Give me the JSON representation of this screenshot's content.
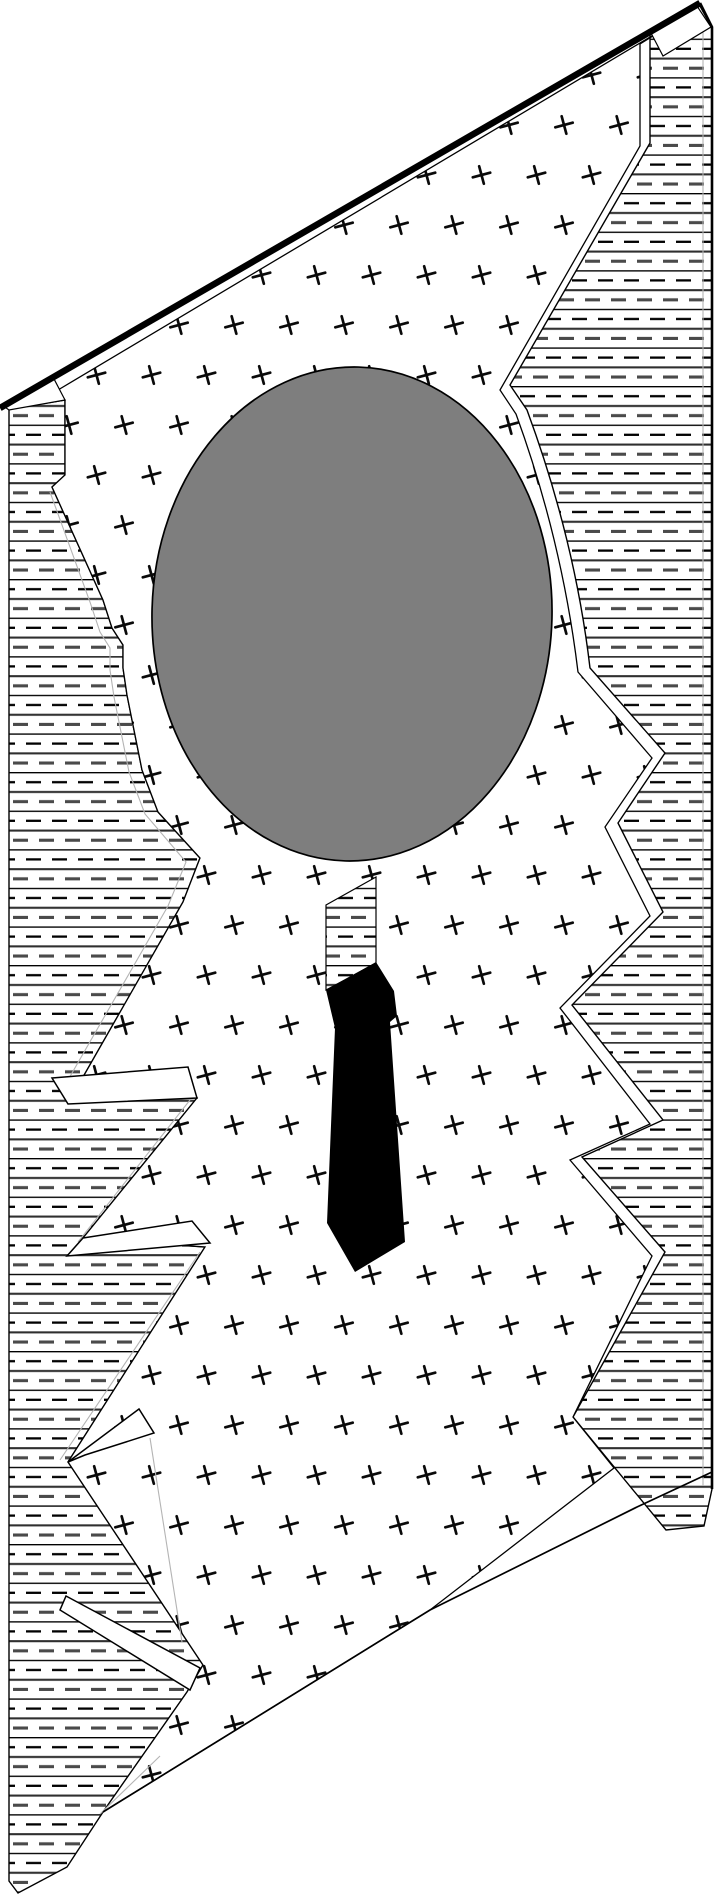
{
  "illustration": {
    "title": "torn-sheet-figure-with-head-and-tie",
    "canvas": {
      "width": 717,
      "height": 1898,
      "background": "#ffffff"
    },
    "palette": {
      "ink": "#000000",
      "head_gray": "#7e7e7e",
      "dash_bold": "#4a4a4a",
      "line_mid": "#2f2f2f",
      "underside_gray": "#b4b4b4",
      "white": "#ffffff"
    },
    "patterns": {
      "hatch": {
        "tile_w": 26,
        "tile_h": 38.6,
        "rule_y": [
          0.7,
          20.0
        ],
        "dash_y": [
          10.2,
          29.6
        ],
        "dash_len": 15,
        "dash_gap": 11
      },
      "crosses": {
        "tile_w": 55,
        "tile_h": 100,
        "arm": 9,
        "rotate_deg": -15,
        "stroke_w": 2.7
      }
    },
    "shapes": [
      {
        "name": "left-hatch-band",
        "type": "path",
        "fill": "pattern:hatch",
        "stroke": "#000000",
        "sw": 1.4,
        "d": "M 9,409 L 65,400 L 65,475 L 52,487 L 103,600 L 112,628 L 123,645 L 123,668 L 127,695 L 142,770 L 158,812 L 200,858 L 183,902 L 83,1077 L 197,1098 L 83,1238 L 205,1247 L 68,1462 L 203,1665 L 187,1692 L 103,1812 L 67,1867 L 18,1893 L 9,1881 Z"
      },
      {
        "name": "right-hatch-band",
        "type": "path",
        "fill": "pattern:hatch",
        "stroke": "#000000",
        "sw": 1.4,
        "d": "M 700,6 L 712,28 L 712,1489 L 704,1526 L 666,1530 L 573,1417 L 665,1252 L 582,1157 L 663,1120 L 572,1005 L 663,912 L 618,823 L 665,753 L 590,668 Q 575,540 527,410 L 510,385 L 650,143 L 650,33 Z"
      },
      {
        "name": "cross-hatched-surface",
        "type": "path",
        "fill": "pattern:crosses",
        "stroke": "#000000",
        "sw": 1.3,
        "d": "M 58,390 L 692,12 L 640,44 L 640,146 L 500,390 L 516,414 Q 562,540 578,672 L 652,758 L 605,827 L 650,916 L 560,1008 L 650,1124 L 570,1160 L 652,1256 L 573,1417 L 614,1468 L 430,1610 L 103,1812 L 187,1692 L 203,1665 L 68,1462 L 205,1247 L 83,1238 L 197,1098 L 83,1077 L 183,902 L 200,858 L 158,812 L 142,770 L 127,695 L 123,668 L 123,645 L 112,628 L 103,600 L 52,487 L 65,475 L 65,400 Z"
      },
      {
        "name": "underside-line-right",
        "type": "polyline",
        "fill": "none",
        "stroke": "#b4b4b4",
        "sw": 1.1,
        "points": "703,30 703,1486"
      },
      {
        "name": "underside-line-left",
        "type": "polyline",
        "fill": "none",
        "stroke": "#b4b4b4",
        "sw": 1.1,
        "points": "50,492 90,602 100,632 110,648 110,670 114,697 129,772 145,814 186,862 168,906 68,1080"
      },
      {
        "name": "underside-line-flap-a",
        "type": "polyline",
        "fill": "none",
        "stroke": "#b4b4b4",
        "sw": 1.1,
        "points": "190,1100 78,1242"
      },
      {
        "name": "underside-line-flap-b",
        "type": "polyline",
        "fill": "none",
        "stroke": "#b4b4b4",
        "sw": 1.1,
        "points": "200,1252 60,1460"
      },
      {
        "name": "underside-line-flap-c",
        "type": "polyline",
        "fill": "none",
        "stroke": "#b4b4b4",
        "sw": 1.1,
        "points": "150,1438 182,1642"
      },
      {
        "name": "underside-line-bottom-left",
        "type": "polyline",
        "fill": "none",
        "stroke": "#b4b4b4",
        "sw": 1.1,
        "points": "160,1756 100,1814"
      },
      {
        "name": "top-left-corner-facet",
        "type": "path",
        "fill": "#ffffff",
        "stroke": "#000000",
        "sw": 1.2,
        "d": "M 2,405 L 53,377 L 65,400 L 9,410 Z"
      },
      {
        "name": "top-right-corner-facet",
        "type": "path",
        "fill": "#ffffff",
        "stroke": "#000000",
        "sw": 1.2,
        "d": "M 651,33 L 697,6 L 711,27 L 663,56 Z"
      },
      {
        "name": "torn-flap-a",
        "type": "path",
        "fill": "#ffffff",
        "stroke": "#000000",
        "sw": 1.5,
        "d": "M 52,1078 L 188,1067 L 197,1098 L 68,1104 Z"
      },
      {
        "name": "torn-flap-b",
        "type": "path",
        "fill": "#ffffff",
        "stroke": "#000000",
        "sw": 1.5,
        "d": "M 83,1238 L 192,1221 L 210,1243 L 67,1256 Z"
      },
      {
        "name": "torn-flap-c",
        "type": "path",
        "fill": "#ffffff",
        "stroke": "#000000",
        "sw": 1.5,
        "d": "M 68,1462 L 139,1409 L 154,1433 L 85,1455 Z"
      },
      {
        "name": "torn-flap-d",
        "type": "path",
        "fill": "#ffffff",
        "stroke": "#000000",
        "sw": 1.5,
        "d": "M 66,1596 L 200,1668 L 190,1690 L 60,1610 Z"
      },
      {
        "name": "neck-hatch-patch",
        "type": "path",
        "fill": "pattern:hatch",
        "stroke": "#000000",
        "sw": 1.2,
        "d": "M 326,905 L 376,877 L 376,963 L 326,990 Z"
      },
      {
        "name": "head-ellipse",
        "type": "ellipse",
        "cx": 352,
        "cy": 614,
        "rx": 200,
        "ry": 247,
        "fill": "#7e7e7e",
        "stroke": "#000000",
        "sw": 1.7,
        "transform": "rotate(1.5 352 614)"
      },
      {
        "name": "necktie",
        "type": "path",
        "fill": "#000000",
        "stroke": "none",
        "sw": 0,
        "d": "M 326,990 L 376,962 L 394,991 L 397,1016 L 390,1022 L 405,1242 L 355,1272 L 327,1223 L 335,1028 Z"
      },
      {
        "name": "bottom-edge-line",
        "type": "polyline",
        "fill": "none",
        "stroke": "#000000",
        "sw": 1.7,
        "points": "712,1472 637,1507 430,1610 103,1812"
      },
      {
        "name": "right-edge-line",
        "type": "polyline",
        "fill": "none",
        "stroke": "#000000",
        "sw": 2.6,
        "points": "700,3 712,27 712,1489"
      },
      {
        "name": "top-edge-thick-line",
        "type": "polyline",
        "fill": "none",
        "stroke": "#000000",
        "sw": 6.5,
        "points": "0,408 700,3"
      }
    ]
  }
}
